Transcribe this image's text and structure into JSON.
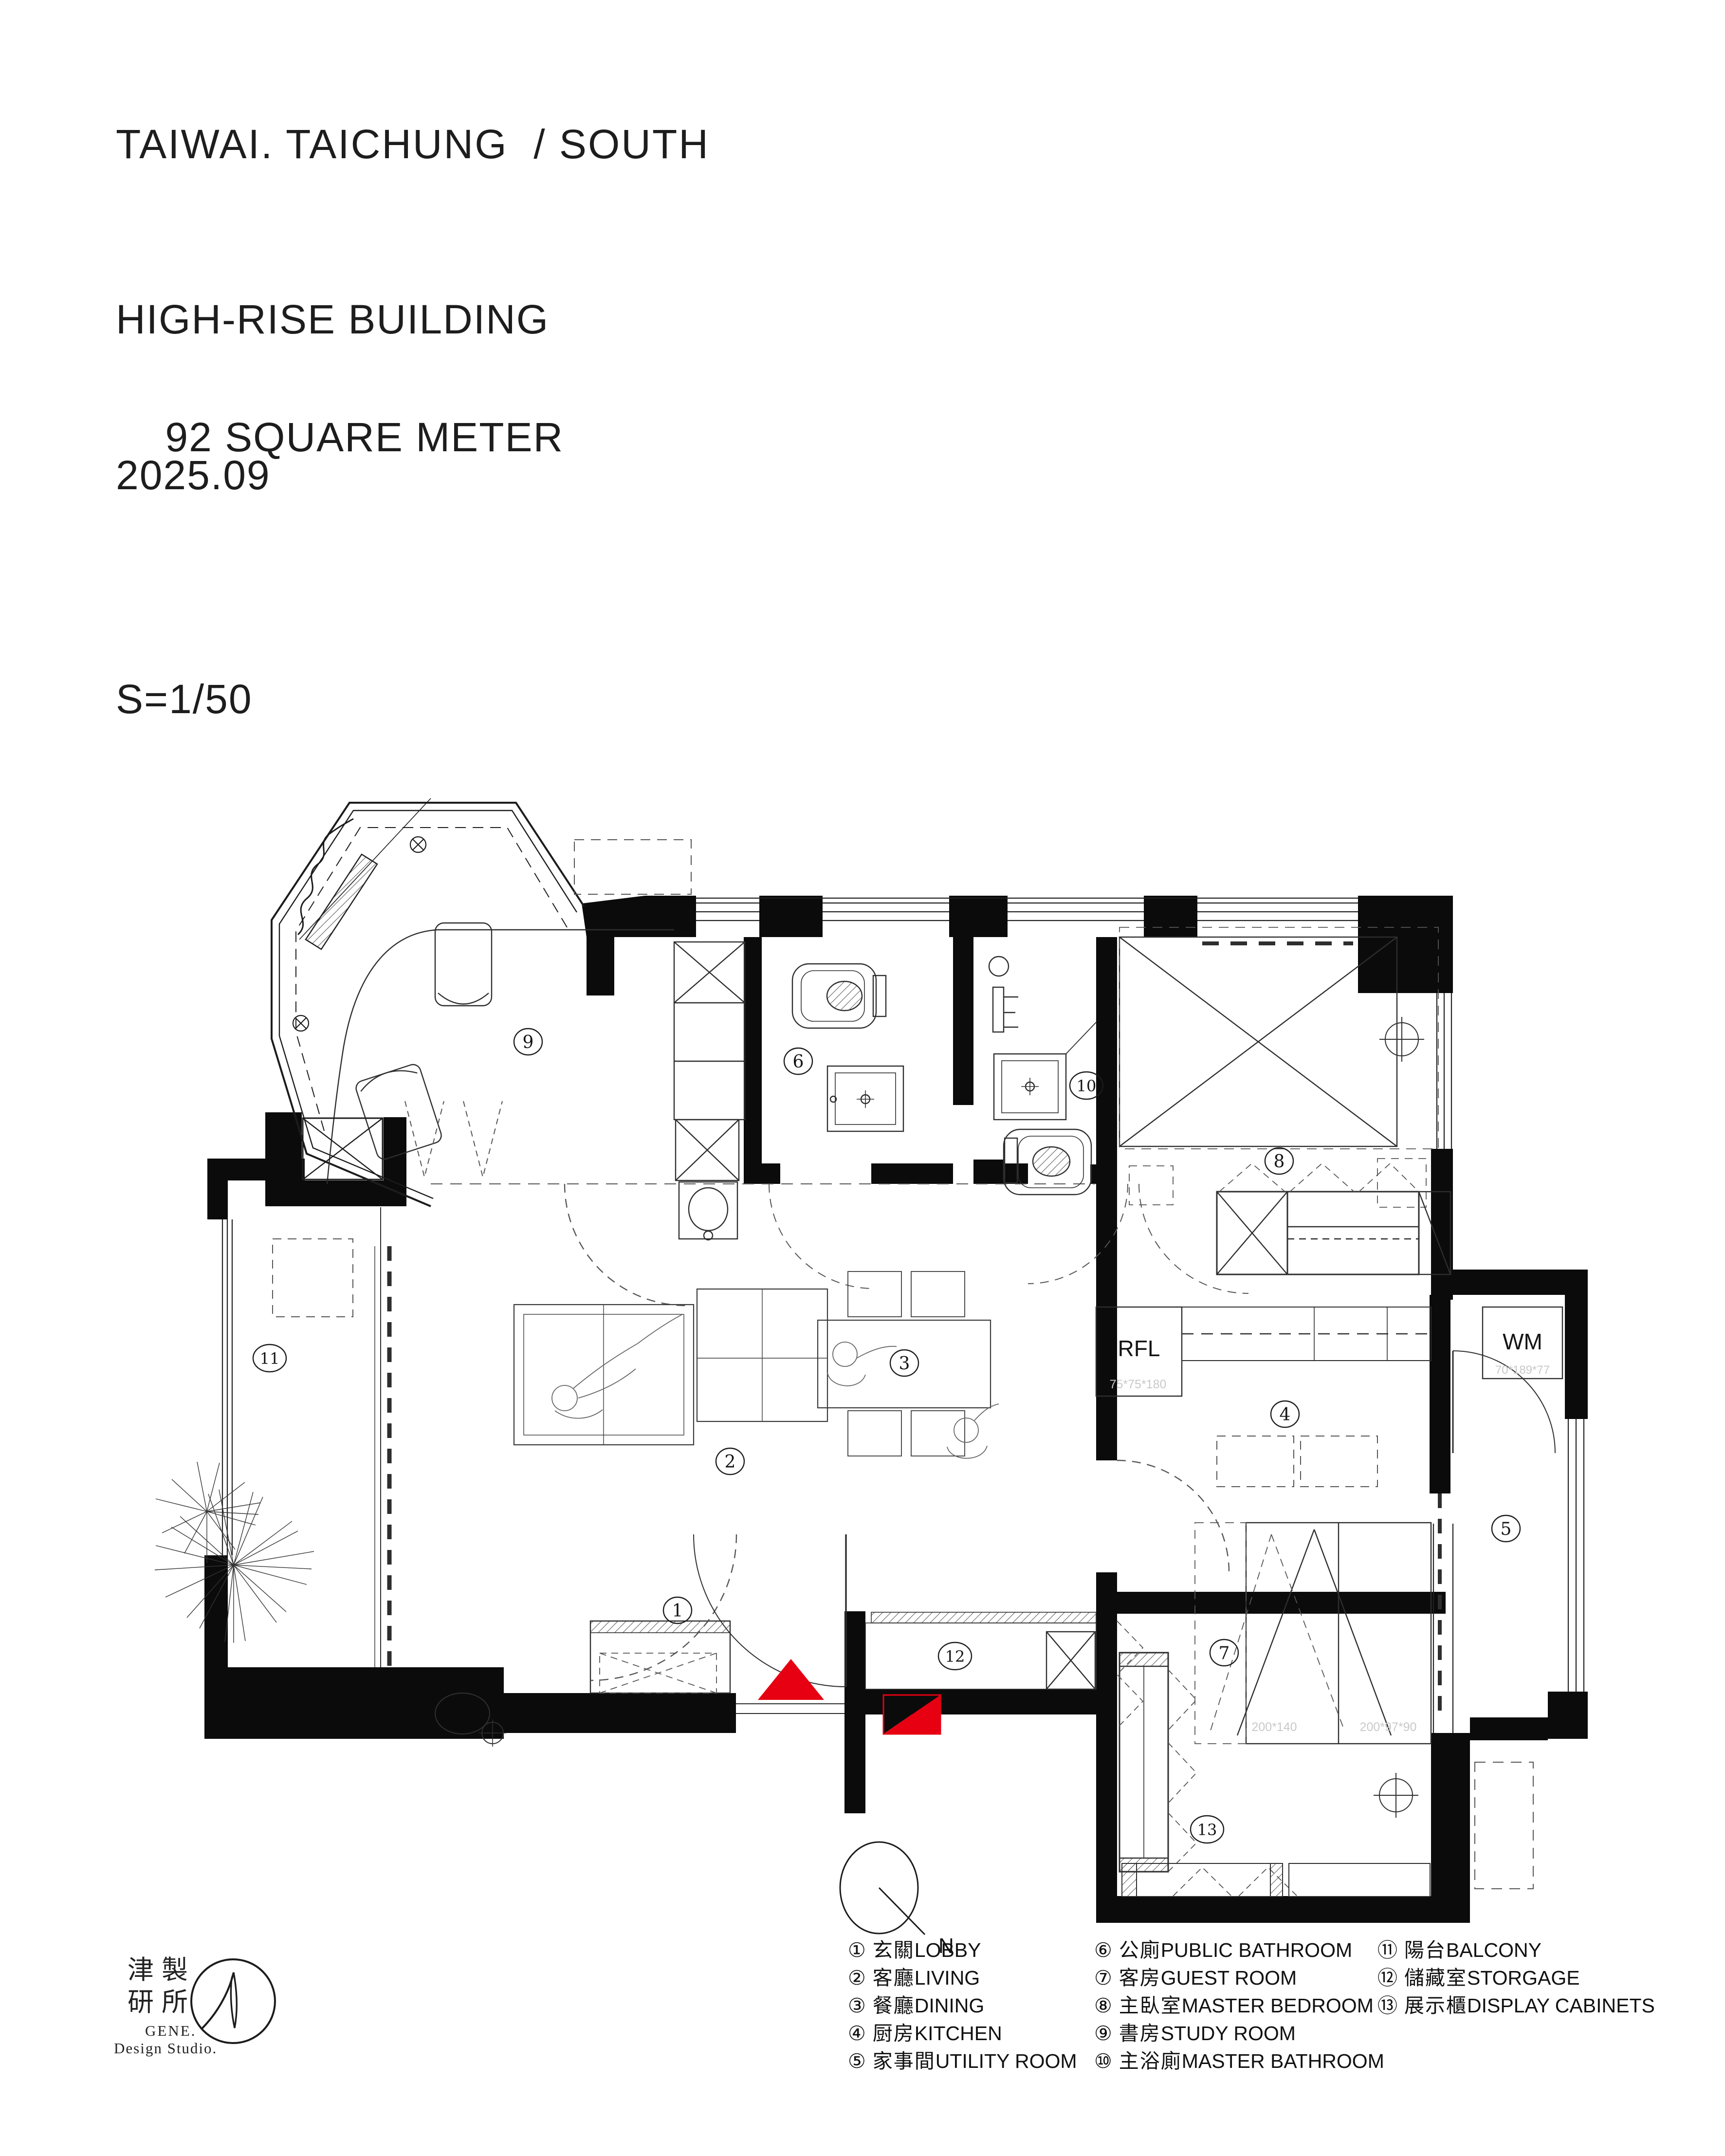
{
  "colors": {
    "red": "#e60012",
    "ink": "#141414",
    "dim_gray": "#c9c9c9"
  },
  "header": {
    "location": "TAIWAI. TAICHUNG  / SOUTH",
    "building": "HIGH-RISE BUILDING",
    "area": "92 SQUARE METER",
    "date": "2025.09",
    "scale": "S=1/50"
  },
  "rooms": [
    {
      "num": "1",
      "symbol": "①",
      "zh": "玄關",
      "en": "LOBBY"
    },
    {
      "num": "2",
      "symbol": "②",
      "zh": "客廳",
      "en": "LIVING"
    },
    {
      "num": "3",
      "symbol": "③",
      "zh": "餐廳",
      "en": "DINING"
    },
    {
      "num": "4",
      "symbol": "④",
      "zh": "厨房",
      "en": "KITCHEN"
    },
    {
      "num": "5",
      "symbol": "⑤",
      "zh": "家事間",
      "en": "UTILITY ROOM"
    },
    {
      "num": "6",
      "symbol": "⑥",
      "zh": "公廁",
      "en": "PUBLIC BATHROOM"
    },
    {
      "num": "7",
      "symbol": "⑦",
      "zh": "客房",
      "en": "GUEST ROOM"
    },
    {
      "num": "8",
      "symbol": "⑧",
      "zh": "主臥室",
      "en": "MASTER BEDROOM"
    },
    {
      "num": "9",
      "symbol": "⑨",
      "zh": "書房",
      "en": "STUDY ROOM"
    },
    {
      "num": "10",
      "symbol": "⑩",
      "zh": "主浴廁",
      "en": "MASTER BATHROOM"
    },
    {
      "num": "11",
      "symbol": "⑪",
      "zh": "陽台",
      "en": "BALCONY"
    },
    {
      "num": "12",
      "symbol": "⑫",
      "zh": "儲藏室",
      "en": "STORGAGE"
    },
    {
      "num": "13",
      "symbol": "⑬",
      "zh": "展示櫃",
      "en": "DISPLAY CABINETS"
    }
  ],
  "plan_annotations": {
    "rfl": "RFL",
    "rfl_dim": "75*75*180",
    "wm": "WM",
    "wm_dim": "70*189*77",
    "guest_bed_dim_1": "200*140",
    "guest_bed_dim_2": "200*97*90",
    "north": "N"
  },
  "logo": {
    "cjk_line1": "津製",
    "cjk_line2": "研所",
    "name": "GENE.",
    "subname": "Design Studio."
  }
}
